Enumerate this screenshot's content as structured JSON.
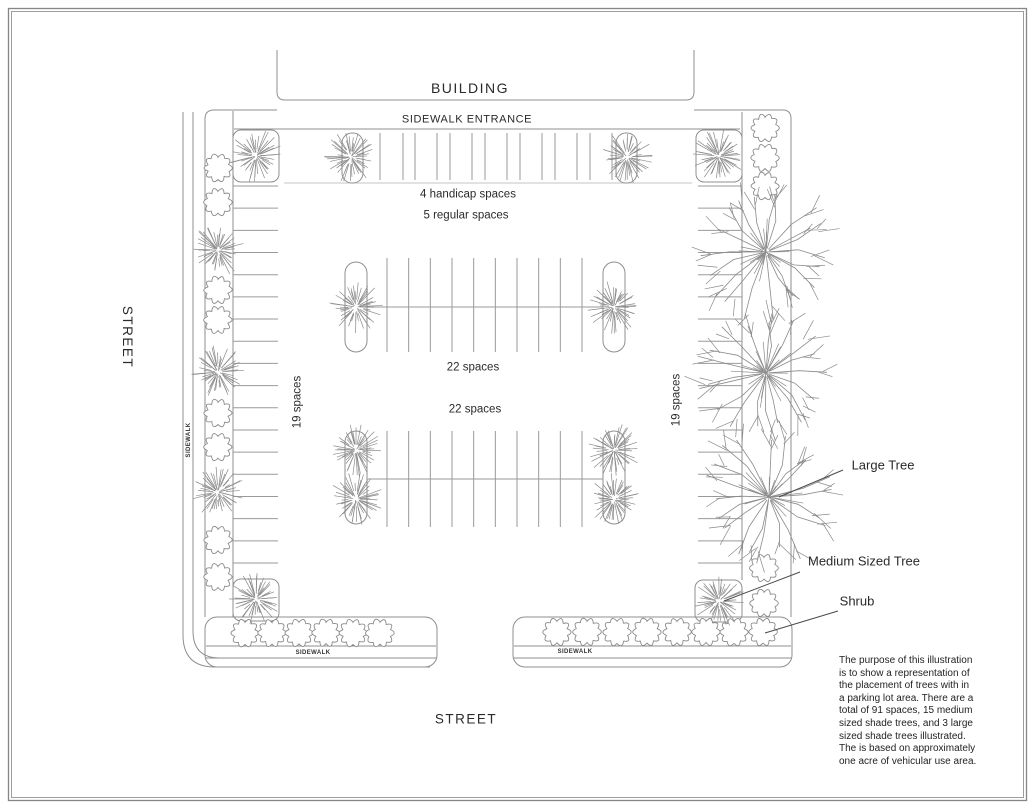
{
  "title": "Parking lot tree placement illustration",
  "colors": {
    "frame": "#868686",
    "line": "#8f8f8f",
    "tick": "#9a9a9a",
    "light_line": "#b3b3b3",
    "tree": "#8a8a8a",
    "leader": "#4a4a4a",
    "text": "#2a2a2a",
    "background": "#ffffff"
  },
  "labels": {
    "building": "BUILDING",
    "sidewalk_entrance": "SIDEWALK ENTRANCE",
    "street_left": "STREET",
    "street_bottom": "STREET",
    "handicap_spaces": "4 handicap spaces",
    "regular_spaces": "5 regular spaces",
    "row2_spaces": "22 spaces",
    "row3_spaces": "22 spaces",
    "left_column_spaces": "19 spaces",
    "right_column_spaces": "19 spaces",
    "sidewalk_left": "SIDEWALK",
    "sidewalk_bottom_left": "SIDEWALK",
    "sidewalk_bottom_right": "SIDEWALK"
  },
  "legend": {
    "large_tree": "Large Tree",
    "medium_tree": "Medium Sized Tree",
    "shrub": "Shrub"
  },
  "caption": "The purpose of this illustration\nis to show a representation of\nthe placement of trees with in\na parking lot area.  There are a\ntotal of 91 spaces, 15 medium\nsized shade trees, and 3 large\nsized shade trees illustrated.\nThe is based on approximately\none acre of vehicular use area.",
  "stats": {
    "total_spaces": 91,
    "medium_shade_trees": 15,
    "large_shade_trees": 3
  },
  "plan": {
    "frame_rects": [
      [
        8.5,
        8.5,
        1018,
        792
      ],
      [
        11.5,
        11.5,
        1012,
        786
      ]
    ],
    "building_path": "M277,50 L277,92 Q277,100 285,100 L686,100 Q694,100 694,92 L694,50",
    "boundary_paths": [
      "M277,110 L214,110 Q205,110 205,119 L205,617",
      "M694,110 L783,110 Q791,110 791,119 L791,617",
      "M233,111 L233,617",
      "M742,112 L742,580",
      "M234,129 L740,129",
      "M183,112 L183,635 Q183,667 215,667 L430,667",
      "M193,112 L193,631 Q193,658 220,658"
    ],
    "light_lines": [
      [
        284,
        183,
        692,
        183
      ]
    ],
    "strip_rects": [
      [
        205,
        617,
        232,
        50,
        12
      ],
      [
        513,
        617,
        279,
        50,
        12
      ]
    ],
    "strip_dividers": [
      [
        206,
        646,
        436,
        646
      ],
      [
        205,
        658,
        437,
        658
      ],
      [
        514,
        646,
        791,
        646
      ],
      [
        513,
        658,
        792,
        658
      ]
    ],
    "planter_rects": [
      [
        233,
        130,
        46,
        52,
        8
      ],
      [
        696,
        130,
        46,
        52,
        8
      ],
      [
        233,
        579,
        46,
        42,
        8
      ],
      [
        695,
        580,
        47,
        42,
        8
      ]
    ],
    "island_rects": [
      [
        342,
        133,
        21,
        50,
        10
      ],
      [
        616,
        133,
        21,
        50,
        10
      ],
      [
        345,
        262,
        22,
        90,
        11
      ],
      [
        603,
        262,
        22,
        90,
        11
      ],
      [
        345,
        431,
        22,
        93,
        11
      ],
      [
        603,
        431,
        22,
        93,
        11
      ]
    ],
    "center_lines": [
      [
        367,
        307,
        603,
        307
      ],
      [
        367,
        479,
        603,
        479
      ]
    ],
    "tick_rows": [
      {
        "dir": "v",
        "xs": [
          380,
          403,
          415,
          437,
          450,
          472,
          485,
          507,
          520,
          542,
          555,
          577,
          590,
          612
        ],
        "from": 133,
        "to": 180
      },
      {
        "dir": "v",
        "start": 387,
        "end": 582,
        "count": 10,
        "from": 258,
        "to": 352
      },
      {
        "dir": "v",
        "start": 387,
        "end": 582,
        "count": 10,
        "from": 431,
        "to": 527
      },
      {
        "dir": "h",
        "start": 186,
        "end": 563,
        "count": 18,
        "from": 233,
        "to": 278
      },
      {
        "dir": "h",
        "start": 186,
        "end": 563,
        "count": 18,
        "from": 698,
        "to": 742
      }
    ],
    "medium_trees": [
      [
        256,
        156
      ],
      [
        351,
        157
      ],
      [
        627,
        157
      ],
      [
        719,
        156
      ],
      [
        218,
        250
      ],
      [
        218,
        372
      ],
      [
        218,
        492
      ],
      [
        256,
        599
      ],
      [
        356,
        307
      ],
      [
        614,
        307
      ],
      [
        356,
        450
      ],
      [
        356,
        499
      ],
      [
        614,
        450
      ],
      [
        614,
        499
      ],
      [
        719,
        601
      ]
    ],
    "medium_tree_radius": 27,
    "large_trees": [
      [
        766,
        252
      ],
      [
        766,
        373
      ],
      [
        769,
        497
      ]
    ],
    "large_tree_radius": 71,
    "shrubs": [
      [
        218,
        168
      ],
      [
        218,
        202
      ],
      [
        218,
        290
      ],
      [
        218,
        320
      ],
      [
        218,
        413
      ],
      [
        218,
        447
      ],
      [
        218,
        540
      ],
      [
        218,
        577
      ],
      [
        245,
        633
      ],
      [
        272,
        633
      ],
      [
        299,
        633
      ],
      [
        326,
        633
      ],
      [
        353,
        633
      ],
      [
        380,
        633
      ],
      [
        557,
        632
      ],
      [
        587,
        632
      ],
      [
        617,
        632
      ],
      [
        647,
        632
      ],
      [
        677,
        632
      ],
      [
        706,
        632
      ],
      [
        734,
        632
      ],
      [
        763,
        632
      ],
      [
        765,
        128
      ],
      [
        765,
        158
      ],
      [
        765,
        186
      ],
      [
        764,
        568
      ],
      [
        764,
        603
      ]
    ],
    "shrub_radius": 14,
    "leader_lines": [
      [
        843,
        470,
        779,
        497
      ],
      [
        800,
        572,
        724,
        601
      ],
      [
        838,
        611,
        765,
        633
      ]
    ]
  }
}
